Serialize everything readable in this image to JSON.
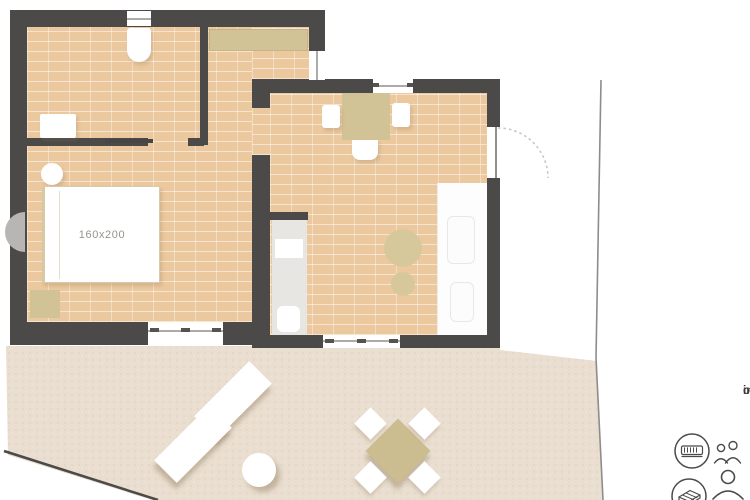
{
  "floorplan": {
    "bed_label": "160x200",
    "stats": {
      "indoor": "indoor: 36.20 sqm",
      "outdoor": "outdoor: 37.70 sqm"
    },
    "legend": {
      "sleeping": {
        "icon": "double-bed-icon",
        "capacity": "two-guests-icon"
      },
      "sofa": {
        "icon": "sofa-bed-icon",
        "capacity": "one-guest-icon"
      }
    },
    "colors": {
      "wall": "#4b4a48",
      "tile_floor": "#ebc89e",
      "terrace_sand": "#e9decf",
      "accent_beige": "#d2c397",
      "furniture_white": "#ffffff",
      "boundary_line": "#8c8c8c"
    }
  }
}
